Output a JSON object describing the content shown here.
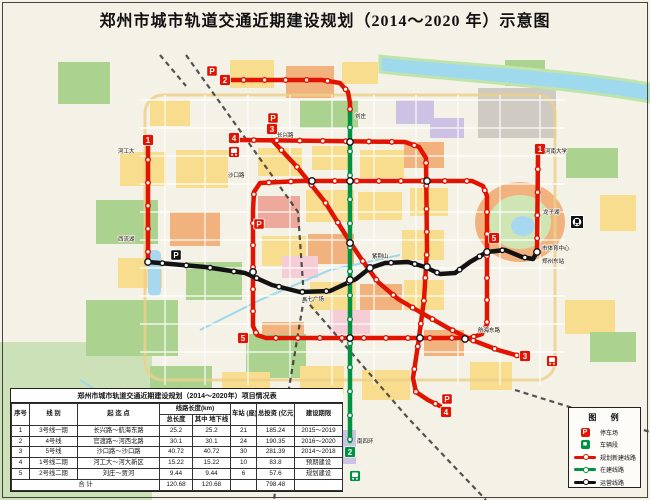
{
  "title": "郑州市城市轨道交通近期建设规划（2014～2020 年）示意图",
  "colors": {
    "planned": "#e01400",
    "construction": "#009141",
    "operating": "#121212",
    "badge_text": "#ffffff"
  },
  "legend": {
    "title": "图 例",
    "items": [
      {
        "icon": "parking",
        "color": "planned",
        "label": "停车场"
      },
      {
        "icon": "depot",
        "color": "construction",
        "label": "车辆段"
      },
      {
        "icon": "line",
        "color": "planned",
        "label": "规划新建线路"
      },
      {
        "icon": "line",
        "color": "construction",
        "label": "在建线路"
      },
      {
        "icon": "line",
        "color": "operating",
        "label": "运营线路"
      }
    ]
  },
  "table": {
    "title": "郑州市城市轨道交通近期建设规划（2014～2020年）项目情况表",
    "headers": {
      "seq": "序号",
      "name": "线 别",
      "section": "起 迄 点",
      "length_group": "线路长度(km)",
      "total_length": "总长度",
      "underground": "其中 地下线",
      "stations": "车站 (座)",
      "investment": "总投资 (亿元)",
      "period": "建设期限"
    },
    "rows": [
      {
        "seq": "1",
        "name": "3号线一期",
        "section": "长兴路～航海东路",
        "len": "25.2",
        "und": "25.2",
        "sta": "21",
        "inv": "185.24",
        "per": "2015～2019"
      },
      {
        "seq": "2",
        "name": "4号线",
        "section": "官渡路～河西北路",
        "len": "30.1",
        "und": "30.1",
        "sta": "24",
        "inv": "190.35",
        "per": "2016～2020"
      },
      {
        "seq": "3",
        "name": "5号线",
        "section": "沙口路～沙口路",
        "len": "40.72",
        "und": "40.72",
        "sta": "30",
        "inv": "281.39",
        "per": "2014～2018"
      },
      {
        "seq": "4",
        "name": "1号线二期",
        "section": "河工大～河大新区",
        "len": "15.22",
        "und": "15.22",
        "sta": "10",
        "inv": "83.8",
        "per": "预期建设"
      },
      {
        "seq": "5",
        "name": "2号线二期",
        "section": "刘庄～贾河",
        "len": "9.44",
        "und": "9.44",
        "sta": "6",
        "inv": "57.6",
        "per": "规划建设"
      }
    ],
    "total": {
      "label": "合 计",
      "len": "120.68",
      "und": "120.68",
      "sta": "",
      "inv": "798.48",
      "per": ""
    }
  },
  "map": {
    "lines": [
      {
        "id": "line5-loop-planned",
        "color": "planned",
        "w": 4.5,
        "closed": true,
        "gap": 22,
        "points": [
          [
            253,
            210
          ],
          [
            253,
            326
          ],
          [
            257,
            335
          ],
          [
            266,
            338
          ],
          [
            410,
            338
          ],
          [
            470,
            338
          ],
          [
            482,
            334
          ],
          [
            487,
            324
          ],
          [
            487,
            196
          ],
          [
            483,
            186
          ],
          [
            472,
            181
          ],
          [
            300,
            181
          ],
          [
            260,
            183
          ],
          [
            254,
            192
          ]
        ]
      },
      {
        "id": "line4-planned",
        "color": "planned",
        "w": 4.5,
        "gap": 23,
        "points": [
          [
            240,
            140
          ],
          [
            330,
            141
          ],
          [
            405,
            142
          ],
          [
            419,
            147
          ],
          [
            426,
            158
          ],
          [
            427,
            250
          ],
          [
            424,
            300
          ],
          [
            418,
            345
          ],
          [
            413,
            378
          ],
          [
            416,
            392
          ],
          [
            428,
            400
          ],
          [
            440,
            406
          ]
        ]
      },
      {
        "id": "line3-planned",
        "color": "planned",
        "w": 4.5,
        "gap": 23,
        "points": [
          [
            272,
            140
          ],
          [
            298,
            168
          ],
          [
            325,
            202
          ],
          [
            350,
            242
          ],
          [
            362,
            260
          ],
          [
            378,
            282
          ],
          [
            398,
            299
          ],
          [
            420,
            312
          ],
          [
            448,
            328
          ],
          [
            472,
            340
          ],
          [
            498,
            350
          ],
          [
            519,
            356
          ]
        ]
      },
      {
        "id": "line2-north-planned",
        "color": "planned",
        "w": 4.5,
        "gap": 21,
        "points": [
          [
            231,
            80
          ],
          [
            322,
            80
          ],
          [
            340,
            83
          ],
          [
            348,
            92
          ],
          [
            350,
            103
          ],
          [
            350,
            113
          ]
        ]
      },
      {
        "id": "line2-under-construction",
        "color": "construction",
        "w": 4.5,
        "gap": 24,
        "points": [
          [
            350,
            113
          ],
          [
            350,
            441
          ]
        ]
      },
      {
        "id": "line1-west-planned",
        "color": "planned",
        "w": 4.5,
        "gap": 23,
        "points": [
          [
            148,
            146
          ],
          [
            148,
            262
          ]
        ]
      },
      {
        "id": "line1-east-planned",
        "color": "planned",
        "w": 4.5,
        "gap": 23,
        "points": [
          [
            537,
            252
          ],
          [
            538,
            155
          ]
        ]
      },
      {
        "id": "line1-operating",
        "color": "operating",
        "w": 4.5,
        "gap": 24,
        "points": [
          [
            148,
            262
          ],
          [
            205,
            267
          ],
          [
            245,
            273
          ],
          [
            272,
            285
          ],
          [
            300,
            292
          ],
          [
            330,
            291
          ],
          [
            356,
            279
          ],
          [
            370,
            268
          ],
          [
            385,
            263
          ],
          [
            408,
            262
          ],
          [
            425,
            267
          ],
          [
            440,
            274
          ],
          [
            455,
            273
          ],
          [
            470,
            262
          ],
          [
            487,
            252
          ],
          [
            505,
            250
          ],
          [
            522,
            257
          ],
          [
            533,
            259
          ],
          [
            537,
            252
          ]
        ]
      }
    ],
    "interchanges": [
      [
        148,
        262
      ],
      [
        253,
        272
      ],
      [
        312,
        181
      ],
      [
        350,
        142
      ],
      [
        350,
        181
      ],
      [
        350,
        243
      ],
      [
        350,
        280
      ],
      [
        350,
        338
      ],
      [
        370,
        268
      ],
      [
        427,
        181
      ],
      [
        427,
        267
      ],
      [
        420,
        338
      ],
      [
        465,
        339
      ],
      [
        487,
        252
      ],
      [
        537,
        252
      ]
    ],
    "badges": [
      {
        "n": "1",
        "x": 148,
        "y": 140
      },
      {
        "n": "1",
        "x": 540,
        "y": 149
      },
      {
        "n": "2",
        "x": 225,
        "y": 80
      },
      {
        "n": "2",
        "x": 350,
        "y": 452,
        "c": "construction"
      },
      {
        "n": "3",
        "x": 272,
        "y": 129
      },
      {
        "n": "3",
        "x": 525,
        "y": 356
      },
      {
        "n": "4",
        "x": 234,
        "y": 138
      },
      {
        "n": "4",
        "x": 446,
        "y": 412
      },
      {
        "n": "5",
        "x": 243,
        "y": 338
      },
      {
        "n": "5",
        "x": 494,
        "y": 238
      }
    ],
    "parking": [
      {
        "x": 212,
        "y": 71
      },
      {
        "x": 273,
        "y": 118
      },
      {
        "x": 176,
        "y": 255,
        "c": "operating"
      },
      {
        "x": 259,
        "y": 224
      },
      {
        "x": 447,
        "y": 399
      }
    ],
    "depots": [
      {
        "x": 234,
        "y": 152
      },
      {
        "x": 552,
        "y": 361
      },
      {
        "x": 355,
        "y": 476,
        "c": "construction"
      }
    ],
    "rail_icons": [
      {
        "x": 577,
        "y": 222
      }
    ],
    "labels": [
      {
        "t": "河工大",
        "x": 118,
        "y": 153
      },
      {
        "t": "西流湖",
        "x": 118,
        "y": 241
      },
      {
        "t": "长兴路",
        "x": 277,
        "y": 137
      },
      {
        "t": "沙口路",
        "x": 228,
        "y": 177
      },
      {
        "t": "刘庄",
        "x": 355,
        "y": 118
      },
      {
        "t": "南四环",
        "x": 357,
        "y": 443
      },
      {
        "t": "二七广场",
        "x": 302,
        "y": 301
      },
      {
        "t": "紫荆山",
        "x": 372,
        "y": 258
      },
      {
        "t": "郑州东站",
        "x": 542,
        "y": 263
      },
      {
        "t": "市体育中心",
        "x": 542,
        "y": 250
      },
      {
        "t": "龙子湖",
        "x": 543,
        "y": 214
      },
      {
        "t": "河南大学",
        "x": 545,
        "y": 153
      },
      {
        "t": "航海东路",
        "x": 478,
        "y": 332
      }
    ]
  }
}
